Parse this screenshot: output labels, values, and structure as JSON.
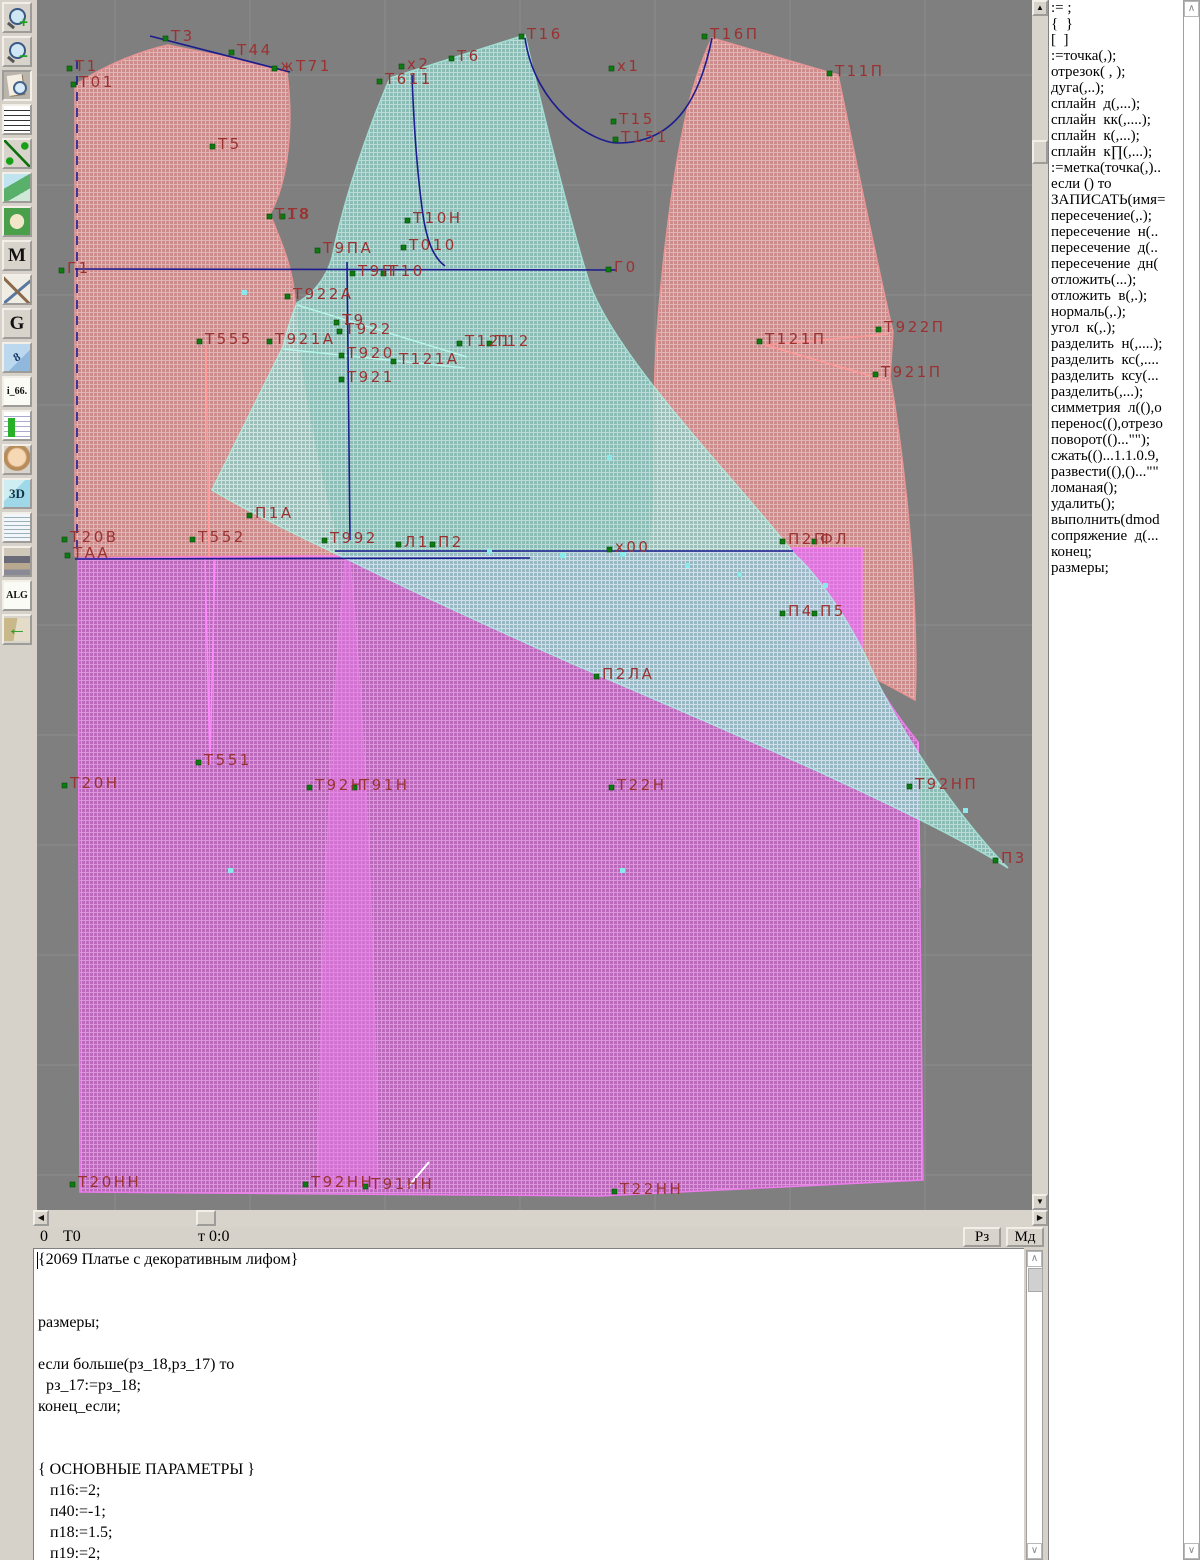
{
  "toolbar": {
    "items": [
      {
        "name": "zoom-in-icon",
        "kind": "mag",
        "badge": "+"
      },
      {
        "name": "zoom-out-icon",
        "kind": "mag",
        "badge": "−"
      },
      {
        "name": "preview-pattern-icon",
        "kind": "docmag",
        "pressed": true
      },
      {
        "name": "grid-icon",
        "kind": "grid"
      },
      {
        "name": "measure-segment-icon",
        "kind": "segment"
      },
      {
        "name": "map-icon",
        "kind": "map"
      },
      {
        "name": "pattern-piece-icon",
        "kind": "piece"
      },
      {
        "name": "m-mode-icon",
        "kind": "letter",
        "text": "M"
      },
      {
        "name": "drafting-tools-icon",
        "kind": "draft"
      },
      {
        "name": "g-mode-icon",
        "kind": "letter",
        "text": "G"
      },
      {
        "name": "ruler-icon",
        "kind": "ruler",
        "text": "8"
      },
      {
        "name": "i66-icon",
        "kind": "plain",
        "text": "i_66."
      },
      {
        "name": "table-icon",
        "kind": "table"
      },
      {
        "name": "portrait-icon",
        "kind": "face"
      },
      {
        "name": "threed-icon",
        "kind": "threed",
        "text": "3D"
      },
      {
        "name": "notes-icon",
        "kind": "lines"
      },
      {
        "name": "books-icon",
        "kind": "books"
      },
      {
        "name": "alg-icon",
        "kind": "plain",
        "text": "ALG"
      },
      {
        "name": "exit-icon",
        "kind": "exit",
        "text": "←"
      }
    ]
  },
  "canvas": {
    "label_color": "#9b3232",
    "marker_color": "#0e7a12",
    "cyan_marker_color": "#8ae9ea",
    "labels": [
      [
        "Т1",
        38,
        58
      ],
      [
        "Т01",
        42,
        74
      ],
      [
        "Т3",
        134,
        28
      ],
      [
        "Т44",
        200,
        42
      ],
      [
        "жТ71",
        243,
        58
      ],
      [
        "Т5",
        181,
        136
      ],
      [
        "Т18",
        238,
        206
      ],
      [
        "Т8",
        251,
        206
      ],
      [
        "Г1",
        30,
        260
      ],
      [
        "Т9ПА",
        286,
        240
      ],
      [
        "Т10Н",
        376,
        210
      ],
      [
        "Т010",
        372,
        237
      ],
      [
        "Т9П",
        321,
        263
      ],
      [
        "Т10",
        352,
        263
      ],
      [
        "Г0",
        577,
        259
      ],
      [
        "Т922А",
        256,
        286
      ],
      [
        "Т9",
        305,
        312
      ],
      [
        "Т922",
        308,
        321
      ],
      [
        "Т921А",
        238,
        331
      ],
      [
        "Т555",
        168,
        331
      ],
      [
        "Т920",
        310,
        345
      ],
      [
        "Т121А",
        362,
        351
      ],
      [
        "Т121",
        428,
        333
      ],
      [
        "Т12",
        458,
        333
      ],
      [
        "Т921",
        310,
        369
      ],
      [
        "Т16",
        490,
        26
      ],
      [
        "Т6",
        420,
        48
      ],
      [
        "х2",
        370,
        56
      ],
      [
        "Т611",
        348,
        71
      ],
      [
        "х1",
        580,
        58
      ],
      [
        "Т15",
        582,
        111
      ],
      [
        "Т151",
        584,
        129
      ],
      [
        "Т16П",
        673,
        26
      ],
      [
        "Т11П",
        798,
        63
      ],
      [
        "Т121П",
        728,
        331
      ],
      [
        "Т922П",
        847,
        319
      ],
      [
        "Т921П",
        844,
        364
      ],
      [
        "П1А",
        218,
        505
      ],
      [
        "Т20В",
        33,
        529
      ],
      [
        "ТАА",
        36,
        545
      ],
      [
        "Т552",
        161,
        529
      ],
      [
        "Т992",
        293,
        530
      ],
      [
        "Л1",
        367,
        534
      ],
      [
        "П2",
        401,
        534
      ],
      [
        "х00",
        578,
        539
      ],
      [
        "П2П",
        751,
        531
      ],
      [
        "ФЛ",
        783,
        531
      ],
      [
        "П4",
        751,
        603
      ],
      [
        "П5",
        783,
        603
      ],
      [
        "П2ЛА",
        565,
        666
      ],
      [
        "Т551",
        167,
        752
      ],
      [
        "Т20Н",
        33,
        775
      ],
      [
        "Т92Н",
        278,
        777
      ],
      [
        "Т91Н",
        323,
        777
      ],
      [
        "Т22Н",
        580,
        777
      ],
      [
        "Т92НП",
        878,
        776
      ],
      [
        "П3",
        964,
        850
      ],
      [
        "Т20НН",
        41,
        1174
      ],
      [
        "Т92НН",
        274,
        1174
      ],
      [
        "Т91НН",
        334,
        1176
      ],
      [
        "Т22НН",
        583,
        1181
      ]
    ],
    "cyan_markers": [
      [
        205,
        290
      ],
      [
        570,
        455
      ],
      [
        786,
        583
      ],
      [
        583,
        868
      ],
      [
        191,
        868
      ],
      [
        926,
        808
      ],
      [
        450,
        549
      ],
      [
        523,
        553
      ],
      [
        583,
        552
      ],
      [
        648,
        563
      ],
      [
        700,
        572
      ]
    ]
  },
  "sidebar": {
    "items": [
      ":= ;",
      "{  }",
      "[  ]",
      ":=точка(,);",
      "отрезок( , );",
      "дуга(,..);",
      "сплайн  д(,...);",
      "сплайн  кк(,....);",
      "сплайн  к(,...);",
      "сплайн  к∏(,...);",
      ":=метка(точка(,)..",
      "если () то",
      "ЗАПИСАТЬ(имя=",
      "пересечение(,.);",
      "пересечение  н(..",
      "пересечение  д(..",
      "пересечение  дн(",
      "отложить(...);",
      "отложить  в(,.);",
      "нормаль(,.);",
      "угол  к(,.);",
      "разделить  н(,....);",
      "разделить  кс(,....",
      "разделить  ксу(...",
      "разделить(,...);",
      "симметрия  л((),о",
      "перенос((),отрезо",
      "поворот(()...\"\");",
      "сжать(()...1.1.0.9,",
      "развести((),()...\"\"",
      "ломаная();",
      "удалить();",
      "выполнить(dmod",
      "сопряжение  д(...",
      "конец;",
      "размеры;"
    ]
  },
  "status": {
    "a": "0",
    "b": "Т0",
    "c": "т 0:0",
    "rz": "Рз",
    "md": "Мд"
  },
  "scroll": {
    "up": "▲",
    "down": "▼",
    "left": "◀",
    "right": "▶",
    "fup": "∧",
    "fdown": "∨"
  },
  "code": {
    "lines": [
      "{2069 Платье с декоративным лифом}",
      "",
      "",
      "размеры;",
      "",
      "если больше(рз_18,рз_17) то",
      "  рз_17:=рз_18;",
      "конец_если;",
      "",
      "",
      "{ ОСНОВНЫЕ ПАРАМЕТРЫ }",
      "   п16:=2;",
      "   п40:=-1;",
      "   п18:=1.5;",
      "   п19:=2;"
    ]
  }
}
